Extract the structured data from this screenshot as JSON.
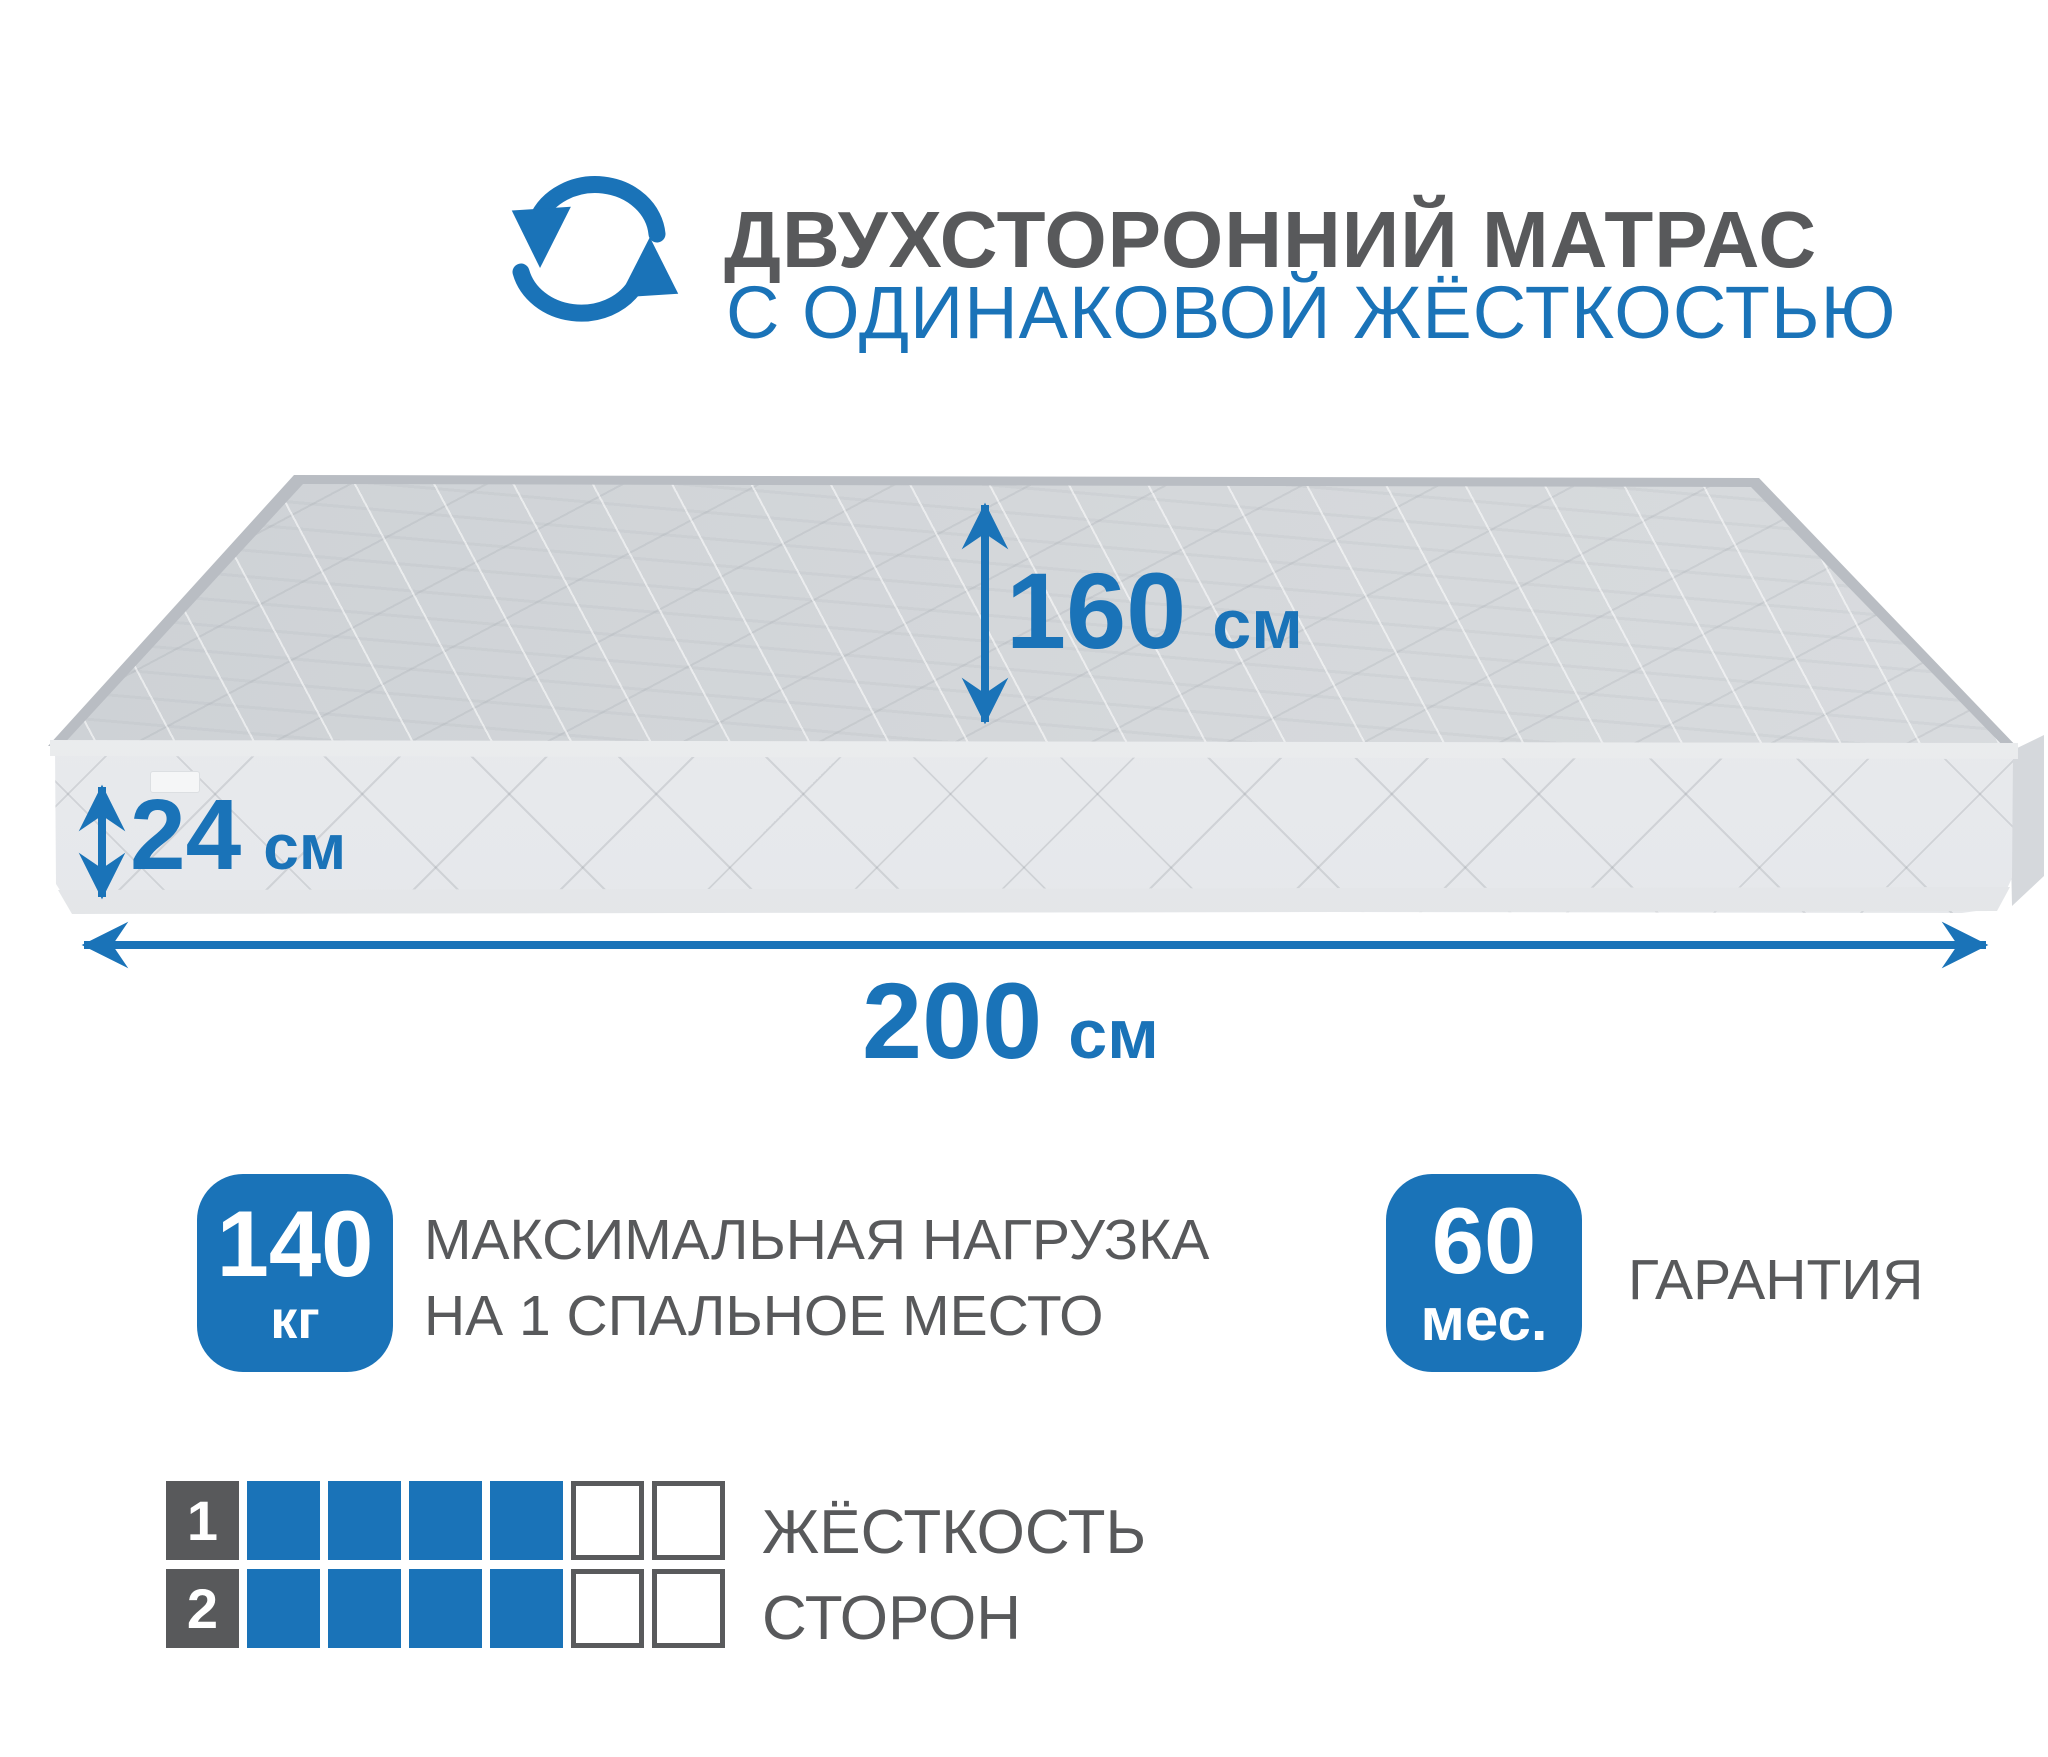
{
  "header": {
    "title_line1": "ДВУХСТОРОННИЙ МАТРАС",
    "title_line2": "С ОДИНАКОВОЙ ЖЁСТКОСТЬЮ",
    "icon": "rotate-arrows-icon"
  },
  "dimensions": {
    "width": {
      "value": "160",
      "unit": "см"
    },
    "height": {
      "value": "24",
      "unit": "см"
    },
    "length": {
      "value": "200",
      "unit": "см"
    }
  },
  "badges": {
    "max_load": {
      "value": "140",
      "unit": "кг",
      "caption_line1": "МАКСИМАЛЬНАЯ НАГРУЗКА",
      "caption_line2": "НА 1 СПАЛЬНОЕ МЕСТО"
    },
    "warranty": {
      "value": "60",
      "unit": "мес.",
      "caption": "ГАРАНТИЯ"
    }
  },
  "firmness": {
    "rows": [
      {
        "label": "1",
        "filled": 4,
        "empty": 2
      },
      {
        "label": "2",
        "filled": 4,
        "empty": 2
      }
    ],
    "scale_total": 6,
    "caption_line1": "ЖЁСТКОСТЬ",
    "caption_line2": "СТОРОН"
  },
  "colors": {
    "accent_blue": "#1a73b8",
    "dark_gray": "#58595b",
    "mattress_top": "#d3d6da",
    "mattress_front": "#e8eaed"
  }
}
